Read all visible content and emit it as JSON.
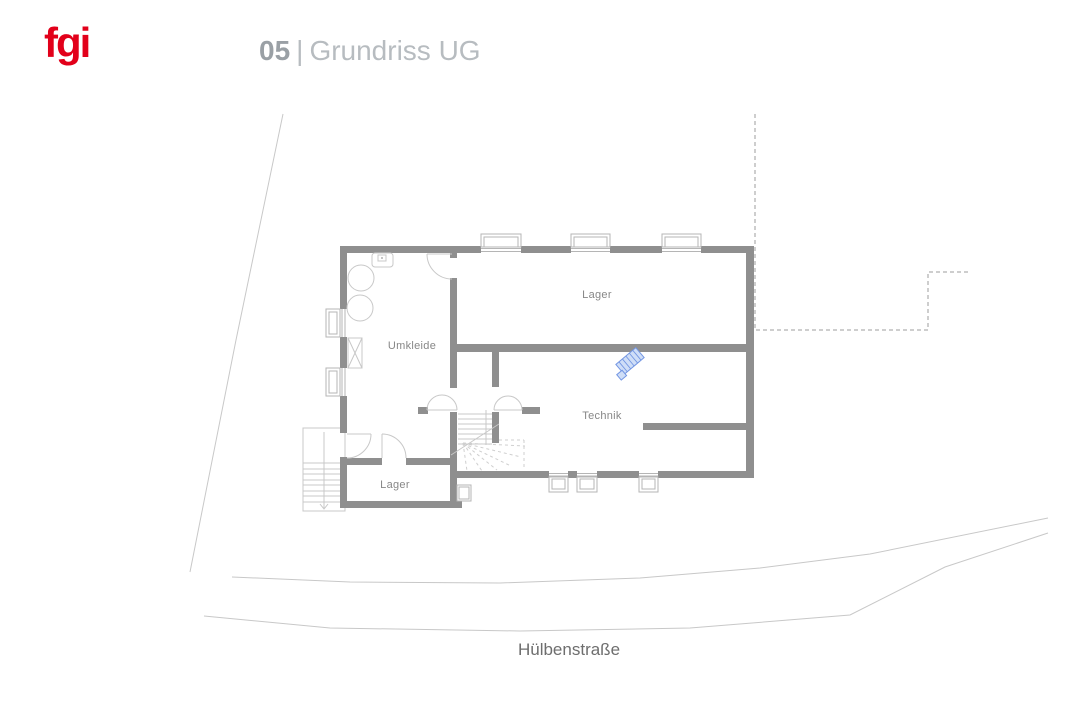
{
  "header": {
    "logo_text": "fgi",
    "title_number": "05",
    "title_separator": "|",
    "title_name": "Grundriss UG"
  },
  "plan": {
    "rooms": [
      {
        "id": "lager-main",
        "label": "Lager"
      },
      {
        "id": "umkleide",
        "label": "Umkleide"
      },
      {
        "id": "technik",
        "label": "Technik"
      },
      {
        "id": "lager-small",
        "label": "Lager"
      }
    ],
    "street_label": "Hülbenstraße",
    "symbols": [
      {
        "name": "hvac-unit-symbol",
        "color": "#7396e3"
      },
      {
        "name": "stair-direction-arrow",
        "direction": "down"
      }
    ]
  },
  "colors": {
    "logo_red": "#e2001a",
    "wall_gray": "#8f8f8f",
    "line_light": "#c8c8c8",
    "line_medium": "#b5b5b5",
    "dash_gray": "#9e9e9e",
    "accent_blue": "#7396e3",
    "accent_blue_fill": "#cfdef7",
    "title_number": "#9aa0a5",
    "title_name": "#b7bcc0",
    "label_gray": "#878787",
    "street_text": "#6e6e6e"
  }
}
